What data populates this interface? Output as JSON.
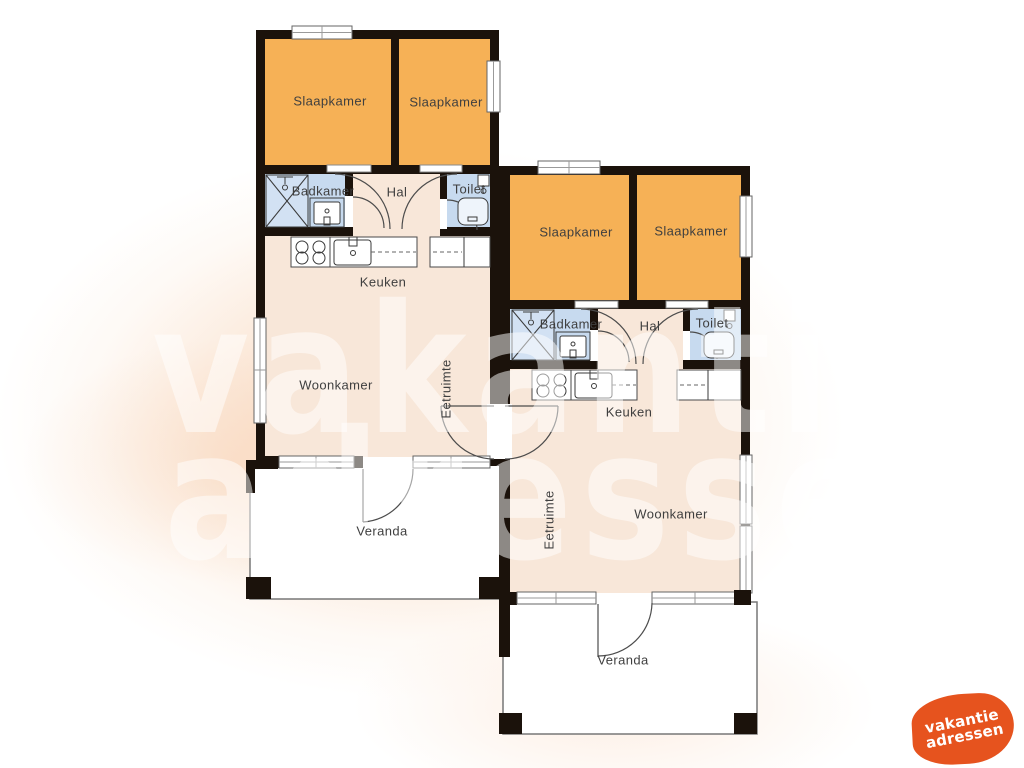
{
  "watermark": {
    "line1": "vakantie",
    "line2": "adressen"
  },
  "logo": {
    "line1": "vakantie",
    "line2": "adressen",
    "color": "#e6531e"
  },
  "colors": {
    "wall": "#1b120b",
    "floor": "#f8e7d9",
    "bedroom": "#f6b156",
    "wet_room": "#c7daef",
    "veranda": "#ffffff",
    "glow": "#f3b280",
    "label_text": "#3f3f3f"
  },
  "units": [
    {
      "name": "unit-left",
      "rooms": [
        {
          "key": "slaapkamer-1",
          "label": "Slaapkamer"
        },
        {
          "key": "slaapkamer-2",
          "label": "Slaapkamer"
        },
        {
          "key": "badkamer",
          "label": "Badkamer"
        },
        {
          "key": "hal",
          "label": "Hal"
        },
        {
          "key": "toilet",
          "label": "Toilet"
        },
        {
          "key": "keuken",
          "label": "Keuken"
        },
        {
          "key": "woonkamer",
          "label": "Woonkamer"
        },
        {
          "key": "eetruimte",
          "label": "Eetruimte"
        },
        {
          "key": "veranda",
          "label": "Veranda"
        }
      ]
    },
    {
      "name": "unit-right",
      "rooms": [
        {
          "key": "slaapkamer-1",
          "label": "Slaapkamer"
        },
        {
          "key": "slaapkamer-2",
          "label": "Slaapkamer"
        },
        {
          "key": "badkamer",
          "label": "Badkamer"
        },
        {
          "key": "hal",
          "label": "Hal"
        },
        {
          "key": "toilet",
          "label": "Toilet"
        },
        {
          "key": "keuken",
          "label": "Keuken"
        },
        {
          "key": "woonkamer",
          "label": "Woonkamer"
        },
        {
          "key": "eetruimte",
          "label": "Eetruimte"
        },
        {
          "key": "veranda",
          "label": "Veranda"
        }
      ]
    }
  ]
}
